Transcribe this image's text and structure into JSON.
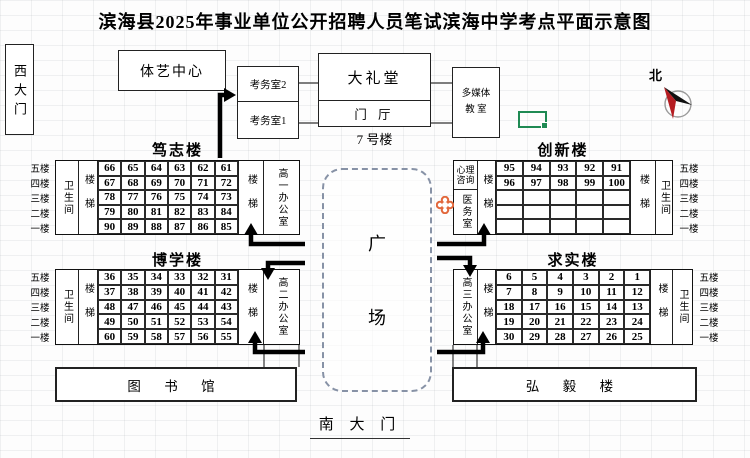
{
  "title": "滨海县2025年事业单位公开招聘人员笔试滨海中学考点平面示意图",
  "compass_label": "北",
  "west_gate": "西大门",
  "south_gate": "南 大 门",
  "top_area": {
    "sports_center": "体艺中心",
    "exam_office_2": "考务室2",
    "exam_office_1": "考务室1",
    "auditorium": "大礼堂",
    "foyer": "门 厅",
    "building7_label": "7 号楼",
    "multimedia_line1": "多媒体",
    "multimedia_line2": "教 室"
  },
  "plaza": {
    "char1": "广",
    "char2": "场"
  },
  "bottom_area": {
    "library": "图 书 馆",
    "hongyi": "弘 毅 楼"
  },
  "floors": [
    "五楼",
    "四楼",
    "三楼",
    "二楼",
    "一楼"
  ],
  "buildings": {
    "duzhi": {
      "name": "笃志楼",
      "washroom": "卫生间",
      "stairs_left": "楼梯",
      "stairs_right": "楼梯",
      "office": "高一办公室",
      "rooms": [
        [
          "66",
          "65",
          "64",
          "63",
          "62",
          "61"
        ],
        [
          "67",
          "68",
          "69",
          "70",
          "71",
          "72"
        ],
        [
          "78",
          "77",
          "76",
          "75",
          "74",
          "73"
        ],
        [
          "79",
          "80",
          "81",
          "82",
          "83",
          "84"
        ],
        [
          "90",
          "89",
          "88",
          "87",
          "86",
          "85"
        ]
      ]
    },
    "chuangxin": {
      "name": "创新楼",
      "counsel": "心理咨询",
      "medical": "医务室",
      "stairs_left": "楼梯",
      "stairs_right": "楼梯",
      "washroom": "卫生间",
      "rooms": [
        [
          "95",
          "94",
          "93",
          "92",
          "91"
        ],
        [
          "96",
          "97",
          "98",
          "99",
          "100"
        ],
        [
          "",
          "",
          "",
          "",
          ""
        ],
        [
          "",
          "",
          "",
          "",
          ""
        ],
        [
          "",
          "",
          "",
          "",
          ""
        ]
      ]
    },
    "boxue": {
      "name": "博学楼",
      "washroom": "卫生间",
      "stairs_left": "楼梯",
      "stairs_right": "楼梯",
      "office": "高二办公室",
      "rooms": [
        [
          "36",
          "35",
          "34",
          "33",
          "32",
          "31"
        ],
        [
          "37",
          "38",
          "39",
          "40",
          "41",
          "42"
        ],
        [
          "48",
          "47",
          "46",
          "45",
          "44",
          "43"
        ],
        [
          "49",
          "50",
          "51",
          "52",
          "53",
          "54"
        ],
        [
          "60",
          "59",
          "58",
          "57",
          "56",
          "55"
        ]
      ]
    },
    "qiushi": {
      "name": "求实楼",
      "office": "高三办公室",
      "stairs_left": "楼梯",
      "stairs_right": "楼梯",
      "washroom": "卫生间",
      "rooms": [
        [
          "6",
          "5",
          "4",
          "3",
          "2",
          "1"
        ],
        [
          "7",
          "8",
          "9",
          "10",
          "11",
          "12"
        ],
        [
          "18",
          "17",
          "16",
          "15",
          "14",
          "13"
        ],
        [
          "19",
          "20",
          "21",
          "22",
          "23",
          "24"
        ],
        [
          "30",
          "29",
          "28",
          "27",
          "26",
          "25"
        ]
      ]
    }
  },
  "colors": {
    "sel_green": "#1f8a53",
    "marker_orange": "#e2683c",
    "needle_red": "#b51d22",
    "plaza_dash": "#8792a6"
  }
}
